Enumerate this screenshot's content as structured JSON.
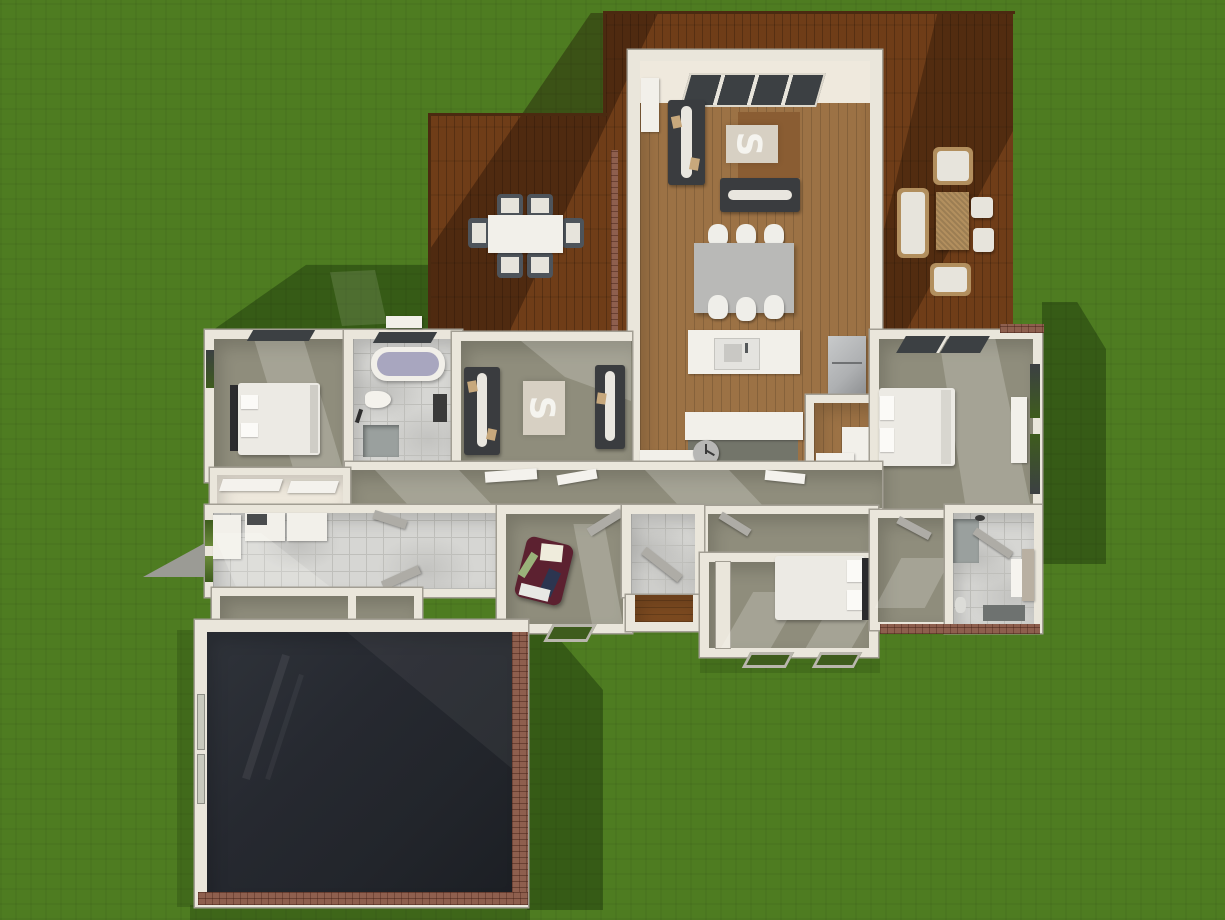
{
  "scene": {
    "title": "aerial-3d-house-floorplan-render",
    "description": "Top-down 3D rendering of a single-story house with an L-shaped wooden deck, furnished interior rooms, dark garage and surrounding green lawn with cast shadows",
    "view": "aerial top-down with soft sun shadows toward lower-left",
    "ground": "grass lawn"
  },
  "palette": {
    "grass": "#4e7c21",
    "shadow": "rgba(16,36,4,0.38)",
    "deck": "#6f3d18",
    "wood": "#9c7245",
    "porchWood": "#7c4a20",
    "wall": "#eae6db",
    "wallEdge": "#a29e93",
    "wallLight": "#efe9dd",
    "carpet": "#8f8d7c",
    "tile": "#d6d6d3",
    "tileLine": "#bfbfbb",
    "garage": "#22252b",
    "sofaDark": "#3a3c3f",
    "throwWhite": "#e9e6df",
    "pillowTan": "#c7a87c",
    "rugLight": "#d7d0c3",
    "rugBrown": "#8a5d33",
    "tableGray": "#b9b9b7",
    "chairWhite": "#efeee9",
    "white": "#f2f0ea",
    "fridge": "#aeb0b2",
    "maroon": "#5c2130",
    "navy": "#2c3550",
    "tubWater": "#a8a6bf",
    "brick": "#8e5f4e",
    "windowDark": "#3c4043",
    "windowGreen": "#3e5c1d",
    "cushion": "#e7e4dc",
    "wicker": "#b28f5e",
    "doorGray": "#aeaca6",
    "clockGray": "#b7b7b5",
    "bedWhite": "#eceae4",
    "showerGray": "#9aa09e"
  },
  "rooms": [
    {
      "name": "living-dining-kitchen",
      "floor": "light wood planks"
    },
    {
      "name": "left-deck",
      "floor": "dark wood deck"
    },
    {
      "name": "right-deck",
      "floor": "dark wood deck"
    },
    {
      "name": "bedroom-top-left",
      "floor": "carpet"
    },
    {
      "name": "bathroom-top-left",
      "floor": "marble tile"
    },
    {
      "name": "sitting-room",
      "floor": "carpet"
    },
    {
      "name": "pantry-closet",
      "floor": "wood"
    },
    {
      "name": "master-bedroom-right",
      "floor": "carpet"
    },
    {
      "name": "master-hall-dressing",
      "floor": "carpet"
    },
    {
      "name": "bathroom-bottom-right",
      "floor": "marble tile"
    },
    {
      "name": "bedroom-bottom",
      "floor": "carpet"
    },
    {
      "name": "office-den",
      "floor": "carpet"
    },
    {
      "name": "entry-hall",
      "floor": "tile + wood porch"
    },
    {
      "name": "hallway",
      "floor": "carpet"
    },
    {
      "name": "laundry-utility",
      "floor": "tile"
    },
    {
      "name": "garage",
      "floor": "dark concrete"
    }
  ],
  "furniture": {
    "left_deck": [
      "outdoor dining table (white top)",
      "6 outdoor chairs (gray frame, light cushions)"
    ],
    "right_deck": [
      "outdoor sofa",
      "2 outdoor armchairs",
      "2 ottomans",
      "wicker coffee table"
    ],
    "living_dining": [
      "4-pane sliding glass door (top wall)",
      "white cabinet",
      "dark sofa with white throw",
      "dark loveseat with white throw",
      "brown area rug",
      "light rug with white S motif",
      "gray dining table",
      "6 white shell chairs"
    ],
    "kitchen": [
      "white island with sink",
      "refrigerator",
      "lower counters",
      "round gray side table (clock face)",
      "pantry L-counter"
    ],
    "bedroom_top_left": [
      "double bed, dark headboard, white duvet, 2 pillows"
    ],
    "bathroom_top_left": [
      "bathtub with water",
      "toilet",
      "shower square",
      "dark towel niche"
    ],
    "sitting_room": [
      "2 dark sofas facing each other",
      "light rug with white S motif"
    ],
    "master_bedroom": [
      "double bed with white duvet and 2 pillows",
      "white wardrobe",
      "2 clerestory skylights"
    ],
    "bathroom_bottom_right": [
      "gray shower",
      "vanity with white towel",
      "dark floor mat",
      "toilet"
    ],
    "bedroom_bottom": [
      "double bed, dark headboard right, 2 pillows",
      "closet wall column"
    ],
    "office": [
      "maroon recliner chair with white pillow, navy and green accessories",
      "white floor box"
    ],
    "laundry": [
      "washer",
      "dryer",
      "white cabinet",
      "bench strip"
    ],
    "garage": [
      "empty dark floor",
      "2 wall window slits",
      "brick wainscot walls"
    ]
  },
  "architecture": [
    "clerestory window slits on top walls",
    "green window wells along lower walls",
    "open door leaves in hallway and rooms",
    "gray exterior door wing on left wall",
    "brick base strips on garage and right wing walls",
    "wood entry porch"
  ]
}
